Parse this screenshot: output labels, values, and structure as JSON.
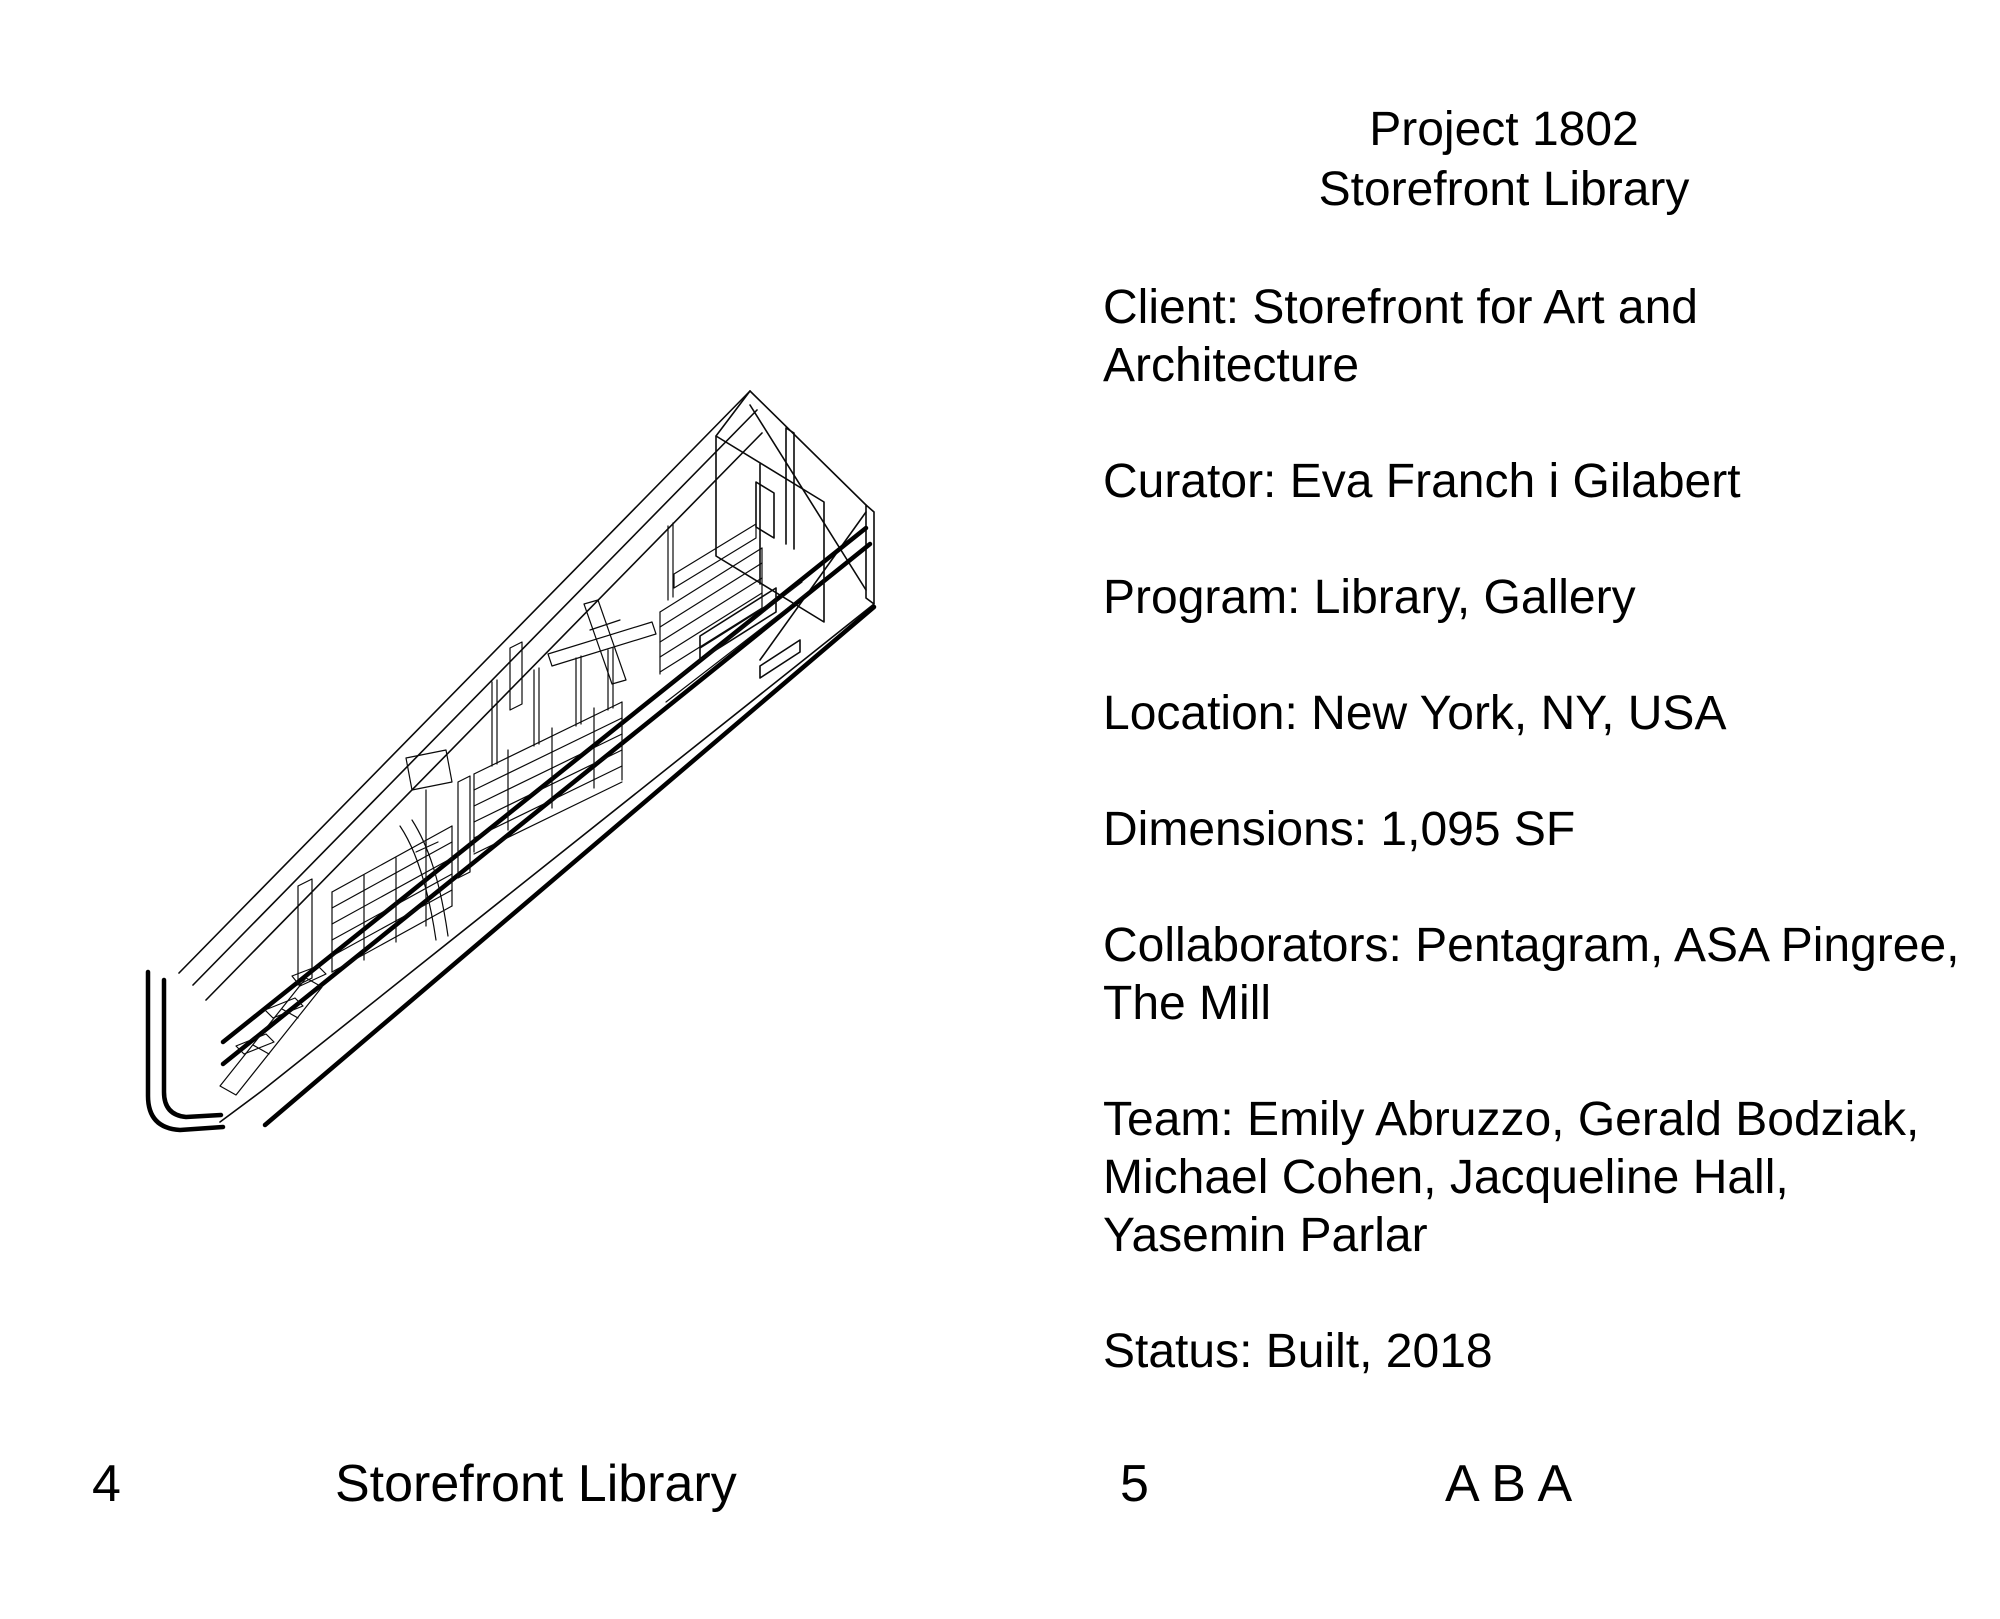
{
  "colors": {
    "paper": "#ffffff",
    "ink": "#000000"
  },
  "left_page": {
    "footer": {
      "page_number": "4",
      "label": "Storefront Library"
    }
  },
  "right_page": {
    "heading": {
      "line1": "Project 1802",
      "line2": "Storefront Library"
    },
    "info": {
      "client": {
        "l1": "Client: Storefront for Art and",
        "l2": "Architecture"
      },
      "curator": {
        "l1": "Curator: Eva Franch i Gilabert"
      },
      "program": {
        "l1": "Program: Library, Gallery"
      },
      "location": {
        "l1": "Location: New York, NY, USA"
      },
      "dimensions": {
        "l1": "Dimensions: 1,095 SF"
      },
      "collaborators": {
        "l1": "Collaborators: Pentagram, ASA Pingree,",
        "l2": "The Mill"
      },
      "team": {
        "l1": "Team: Emily Abruzzo, Gerald Bodziak,",
        "l2": "Michael Cohen, Jacqueline Hall,",
        "l3": "Yasemin Parlar"
      },
      "status": {
        "l1": "Status: Built, 2018"
      }
    },
    "footer": {
      "page_number": "5",
      "label": "A B A"
    }
  }
}
